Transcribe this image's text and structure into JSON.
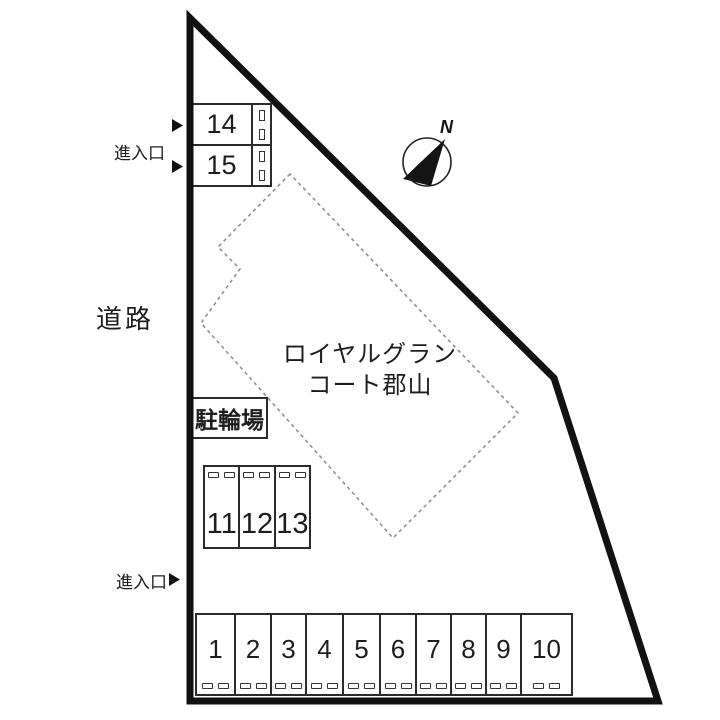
{
  "labels": {
    "road": "道路",
    "entrance_top": "進入口",
    "entrance_bottom": "進入口",
    "bicycle_parking": "駐輪場",
    "building_name_line1": "ロイヤルグラン",
    "building_name_line2": "コート郡山",
    "compass_north": "N"
  },
  "parking": {
    "row_top": [
      "14",
      "15"
    ],
    "row_mid": [
      "11",
      "12",
      "13"
    ],
    "row_bottom": [
      "1",
      "2",
      "3",
      "4",
      "5",
      "6",
      "7",
      "8",
      "9",
      "10"
    ]
  },
  "colors": {
    "background": "#ffffff",
    "boundary": "#121212",
    "stall_line": "#2b2b2b",
    "building_dash": "#8f8f8f",
    "text": "#1d1d1d"
  }
}
